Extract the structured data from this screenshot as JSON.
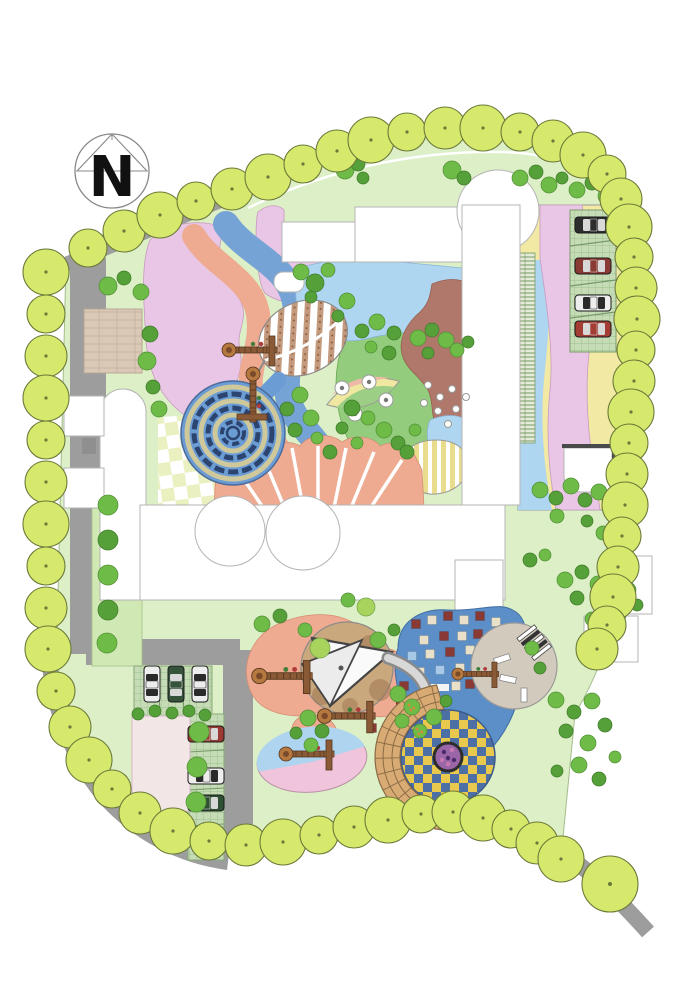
{
  "title": "Kindergarten landscape master plan",
  "compass": {
    "label": "N"
  },
  "palette": {
    "lawn": "#dcefc6",
    "lawnEdge": "#a4bd8a",
    "road": "#9d9d9d",
    "treeFill": "#d7e96d",
    "treeEdge": "#6b7a3a",
    "bushDark": "#55a038",
    "bushMid": "#6fbb48",
    "bushLight": "#a8d45e",
    "pink": "#e9c6e5",
    "salmon": "#eeab92",
    "brown": "#b0786b",
    "lblue": "#aed6f0",
    "ribbon": "#76a3d6",
    "mound": "#93cc7d",
    "yellow": "#f2e9a4",
    "stripeYellow": "#e9dd8d",
    "mazeBlue": "#6b9cd4",
    "mazeWall": "#2c4470",
    "mazePath": "#cfc89a",
    "beige": "#dbc9b7",
    "beigeLine": "#c2ae99",
    "checkPale": "#eaf0c0",
    "checkYellow": "#e9c94d",
    "checkBlue": "#4c6fa5",
    "playBlue": "#5c8fc7",
    "sand": "#caa87e",
    "sandDark": "#9a6f4c",
    "amphi": "#d9ab74",
    "amphiLine": "#8a6a46",
    "plazaPink": "#f2e6e6",
    "paver": "#c6dcb6",
    "paverLine": "#8fb97f",
    "spiral": "#9a66a8",
    "squareCream": "#e8e0c8",
    "squareRed": "#8a3a34",
    "squareBlue": "#a8c8e8"
  },
  "trees": {
    "perimeter": [
      [
        88,
        248
      ],
      [
        124,
        231
      ],
      [
        160,
        215
      ],
      [
        196,
        201
      ],
      [
        232,
        189
      ],
      [
        268,
        177
      ],
      [
        303,
        164
      ],
      [
        337,
        151
      ],
      [
        371,
        140
      ],
      [
        407,
        132
      ],
      [
        445,
        128
      ],
      [
        483,
        128
      ],
      [
        520,
        132
      ],
      [
        553,
        141
      ],
      [
        583,
        155
      ],
      [
        607,
        174
      ],
      [
        621,
        199
      ],
      [
        629,
        227
      ],
      [
        634,
        257
      ],
      [
        636,
        288
      ],
      [
        637,
        319
      ],
      [
        636,
        350
      ],
      [
        634,
        381
      ],
      [
        631,
        412
      ],
      [
        629,
        443
      ],
      [
        627,
        474
      ],
      [
        625,
        505
      ],
      [
        622,
        536
      ],
      [
        618,
        567
      ],
      [
        613,
        597
      ],
      [
        607,
        625
      ],
      [
        597,
        649
      ],
      [
        46,
        272
      ],
      [
        46,
        314
      ],
      [
        46,
        356
      ],
      [
        46,
        398
      ],
      [
        46,
        440
      ],
      [
        46,
        482
      ],
      [
        46,
        524
      ],
      [
        46,
        566
      ],
      [
        46,
        608
      ],
      [
        48,
        649
      ],
      [
        56,
        691
      ],
      [
        70,
        727
      ],
      [
        89,
        760
      ],
      [
        112,
        789
      ],
      [
        140,
        813
      ],
      [
        173,
        831
      ],
      [
        209,
        841
      ],
      [
        246,
        845
      ],
      [
        283,
        842
      ],
      [
        319,
        835
      ],
      [
        354,
        827
      ],
      [
        388,
        820
      ],
      [
        421,
        814
      ],
      [
        453,
        812
      ],
      [
        483,
        818
      ],
      [
        511,
        829
      ],
      [
        537,
        843
      ],
      [
        561,
        859
      ]
    ],
    "accent": [
      610,
      884,
      28
    ]
  },
  "bushes": [
    [
      345,
      170,
      9,
      "m"
    ],
    [
      358,
      164,
      7,
      "d"
    ],
    [
      452,
      170,
      9,
      "m"
    ],
    [
      464,
      178,
      7,
      "d"
    ],
    [
      363,
      178,
      6,
      "d"
    ],
    [
      520,
      178,
      8,
      "m"
    ],
    [
      536,
      172,
      7,
      "d"
    ],
    [
      549,
      185,
      8,
      "m"
    ],
    [
      562,
      178,
      6,
      "d"
    ],
    [
      577,
      190,
      8,
      "m"
    ],
    [
      592,
      183,
      7,
      "d"
    ],
    [
      606,
      196,
      8,
      "m"
    ],
    [
      619,
      189,
      6,
      "d"
    ],
    [
      108,
      286,
      9,
      "m"
    ],
    [
      124,
      278,
      7,
      "d"
    ],
    [
      141,
      292,
      8,
      "m"
    ],
    [
      150,
      334,
      8,
      "d"
    ],
    [
      147,
      361,
      9,
      "m"
    ],
    [
      153,
      387,
      7,
      "d"
    ],
    [
      159,
      409,
      8,
      "m"
    ],
    [
      301,
      272,
      8,
      "m"
    ],
    [
      315,
      283,
      9,
      "d"
    ],
    [
      328,
      270,
      7,
      "m"
    ],
    [
      311,
      297,
      6,
      "d"
    ],
    [
      347,
      301,
      8,
      "m"
    ],
    [
      338,
      316,
      6,
      "d"
    ],
    [
      418,
      338,
      8,
      "m"
    ],
    [
      432,
      330,
      7,
      "d"
    ],
    [
      446,
      340,
      8,
      "m"
    ],
    [
      428,
      353,
      6,
      "d"
    ],
    [
      457,
      350,
      7,
      "m"
    ],
    [
      468,
      342,
      6,
      "d"
    ],
    [
      362,
      331,
      7,
      "d"
    ],
    [
      377,
      322,
      8,
      "m"
    ],
    [
      394,
      333,
      7,
      "d"
    ],
    [
      371,
      347,
      6,
      "m"
    ],
    [
      389,
      353,
      7,
      "d"
    ],
    [
      300,
      395,
      8,
      "m"
    ],
    [
      287,
      409,
      7,
      "d"
    ],
    [
      311,
      418,
      8,
      "m"
    ],
    [
      295,
      430,
      7,
      "d"
    ],
    [
      317,
      438,
      6,
      "m"
    ],
    [
      352,
      408,
      8,
      "d"
    ],
    [
      368,
      418,
      7,
      "m"
    ],
    [
      342,
      428,
      6,
      "d"
    ],
    [
      384,
      430,
      8,
      "m"
    ],
    [
      398,
      443,
      7,
      "d"
    ],
    [
      357,
      443,
      6,
      "m"
    ],
    [
      330,
      452,
      7,
      "d"
    ],
    [
      415,
      430,
      6,
      "m"
    ],
    [
      407,
      452,
      7,
      "d"
    ],
    [
      540,
      490,
      8,
      "m"
    ],
    [
      556,
      498,
      7,
      "d"
    ],
    [
      571,
      486,
      8,
      "m"
    ],
    [
      585,
      500,
      7,
      "d"
    ],
    [
      599,
      492,
      8,
      "m"
    ],
    [
      612,
      505,
      7,
      "d"
    ],
    [
      557,
      516,
      7,
      "m"
    ],
    [
      587,
      521,
      6,
      "d"
    ],
    [
      603,
      533,
      7,
      "m"
    ],
    [
      565,
      580,
      8,
      "m"
    ],
    [
      582,
      572,
      7,
      "d"
    ],
    [
      598,
      584,
      8,
      "m"
    ],
    [
      613,
      576,
      6,
      "d"
    ],
    [
      628,
      590,
      8,
      "m"
    ],
    [
      577,
      598,
      7,
      "d"
    ],
    [
      604,
      603,
      7,
      "m"
    ],
    [
      620,
      615,
      6,
      "d"
    ],
    [
      592,
      619,
      7,
      "m"
    ],
    [
      637,
      605,
      6,
      "d"
    ],
    [
      556,
      700,
      8,
      "m"
    ],
    [
      574,
      712,
      7,
      "d"
    ],
    [
      592,
      701,
      8,
      "m"
    ],
    [
      566,
      731,
      7,
      "d"
    ],
    [
      588,
      743,
      8,
      "m"
    ],
    [
      605,
      725,
      7,
      "d"
    ],
    [
      579,
      765,
      8,
      "m"
    ],
    [
      599,
      779,
      7,
      "d"
    ],
    [
      615,
      757,
      6,
      "m"
    ],
    [
      557,
      771,
      6,
      "d"
    ],
    [
      308,
      718,
      8,
      "m"
    ],
    [
      322,
      731,
      7,
      "d"
    ],
    [
      311,
      745,
      7,
      "m"
    ],
    [
      296,
      733,
      6,
      "d"
    ],
    [
      398,
      694,
      8,
      "m"
    ],
    [
      412,
      707,
      8,
      "o"
    ],
    [
      402,
      721,
      7,
      "m"
    ],
    [
      420,
      731,
      7,
      "o"
    ],
    [
      434,
      717,
      8,
      "m"
    ],
    [
      446,
      701,
      6,
      "d"
    ],
    [
      138,
      714,
      6,
      "d"
    ],
    [
      155,
      711,
      6,
      "d"
    ],
    [
      172,
      713,
      6,
      "d"
    ],
    [
      189,
      711,
      6,
      "d"
    ],
    [
      205,
      715,
      6,
      "d"
    ],
    [
      199,
      732,
      10,
      "m"
    ],
    [
      197,
      767,
      10,
      "m"
    ],
    [
      196,
      802,
      10,
      "m"
    ],
    [
      199,
      837,
      10,
      "m"
    ],
    [
      108,
      505,
      10,
      "m"
    ],
    [
      108,
      540,
      10,
      "d"
    ],
    [
      108,
      575,
      10,
      "m"
    ],
    [
      108,
      610,
      10,
      "d"
    ],
    [
      107,
      643,
      10,
      "m"
    ],
    [
      378,
      640,
      8,
      "m"
    ],
    [
      394,
      630,
      6,
      "d"
    ],
    [
      320,
      648,
      10,
      "l"
    ],
    [
      305,
      630,
      7,
      "m"
    ],
    [
      262,
      624,
      8,
      "m"
    ],
    [
      280,
      616,
      7,
      "d"
    ],
    [
      530,
      560,
      7,
      "d"
    ],
    [
      545,
      555,
      6,
      "m"
    ],
    [
      628,
      498,
      14,
      "l"
    ],
    [
      366,
      607,
      9,
      "l"
    ],
    [
      348,
      600,
      7,
      "m"
    ],
    [
      532,
      648,
      7,
      "m"
    ],
    [
      540,
      668,
      6,
      "d"
    ]
  ],
  "cars": [
    {
      "x": 593,
      "y": 225,
      "rot": 0,
      "color": "#2d2d2d"
    },
    {
      "x": 593,
      "y": 266,
      "rot": 0,
      "color": "#8a3a34"
    },
    {
      "x": 593,
      "y": 303,
      "rot": 0,
      "color": "#ededed"
    },
    {
      "x": 593,
      "y": 329,
      "rot": 0,
      "color": "#a33d36"
    },
    {
      "x": 152,
      "y": 684,
      "rot": 90,
      "color": "#ededed"
    },
    {
      "x": 176,
      "y": 684,
      "rot": 90,
      "color": "#35523a"
    },
    {
      "x": 200,
      "y": 684,
      "rot": 90,
      "color": "#ededed"
    },
    {
      "x": 206,
      "y": 734,
      "rot": 0,
      "color": "#9a3a32"
    },
    {
      "x": 206,
      "y": 776,
      "rot": 0,
      "color": "#ededed"
    },
    {
      "x": 206,
      "y": 803,
      "rot": 0,
      "color": "#2f4f33"
    }
  ],
  "play_squares": [
    [
      416,
      624,
      1
    ],
    [
      432,
      620,
      0
    ],
    [
      448,
      616,
      1
    ],
    [
      464,
      620,
      0
    ],
    [
      480,
      616,
      1
    ],
    [
      496,
      622,
      0
    ],
    [
      424,
      640,
      0
    ],
    [
      444,
      636,
      1
    ],
    [
      462,
      636,
      0
    ],
    [
      478,
      634,
      1
    ],
    [
      494,
      638,
      2
    ],
    [
      412,
      656,
      2
    ],
    [
      430,
      654,
      0
    ],
    [
      450,
      652,
      1
    ],
    [
      470,
      650,
      0
    ],
    [
      488,
      652,
      1
    ],
    [
      420,
      672,
      0
    ],
    [
      440,
      670,
      2
    ],
    [
      460,
      668,
      0
    ],
    [
      480,
      668,
      2
    ],
    [
      404,
      686,
      1
    ],
    [
      456,
      686,
      0
    ],
    [
      470,
      684,
      1
    ],
    [
      488,
      684,
      0
    ],
    [
      412,
      724,
      1
    ],
    [
      428,
      728,
      0
    ],
    [
      446,
      726,
      1
    ],
    [
      396,
      742,
      0
    ],
    [
      380,
      672,
      1
    ],
    [
      372,
      728,
      1
    ],
    [
      452,
      744,
      2
    ],
    [
      468,
      740,
      0
    ]
  ],
  "equipment": [
    [
      255,
      350,
      0,
      1
    ],
    [
      253,
      400,
      90,
      1
    ],
    [
      288,
      676,
      0,
      1.1
    ],
    [
      352,
      716,
      0,
      1.05
    ],
    [
      312,
      754,
      0,
      1
    ],
    [
      480,
      674,
      0,
      0.85
    ]
  ],
  "fan": {
    "apex": [
      318,
      588
    ],
    "targets": [
      [
        232,
        462
      ],
      [
        262,
        454
      ],
      [
        292,
        448
      ],
      [
        318,
        446
      ],
      [
        346,
        448
      ],
      [
        374,
        452
      ],
      [
        402,
        460
      ]
    ]
  },
  "amphitheater": {
    "cx": 448,
    "cy": 757,
    "rInner": 48,
    "rOuter": 73,
    "aStart": 75,
    "aEnd": 265,
    "rings": [
      56,
      65
    ],
    "spokeStep": 13
  },
  "mosaic_dots": [
    [
      444,
      752
    ],
    [
      452,
      750
    ],
    [
      448,
      758
    ],
    [
      442,
      760
    ],
    [
      454,
      760
    ],
    [
      448,
      764
    ]
  ],
  "mound_stones": [
    [
      428,
      385
    ],
    [
      440,
      397
    ],
    [
      452,
      389
    ],
    [
      438,
      411
    ],
    [
      456,
      409
    ],
    [
      466,
      397
    ],
    [
      448,
      424
    ],
    [
      424,
      403
    ]
  ],
  "eye_stones": [
    [
      342,
      388
    ],
    [
      369,
      382
    ],
    [
      355,
      414
    ],
    [
      386,
      400
    ]
  ],
  "features": [
    "north-compass",
    "perimeter-tree-row",
    "site-roads",
    "top-parking-lot",
    "bottom-parking-lot",
    "central-courtyard",
    "hedge-maze",
    "leaf-paving",
    "checker-plaza",
    "radial-paving",
    "play-lawn",
    "shade-sail-sandpit",
    "blue-play-court",
    "checker-amphitheater",
    "stepping-stones"
  ]
}
